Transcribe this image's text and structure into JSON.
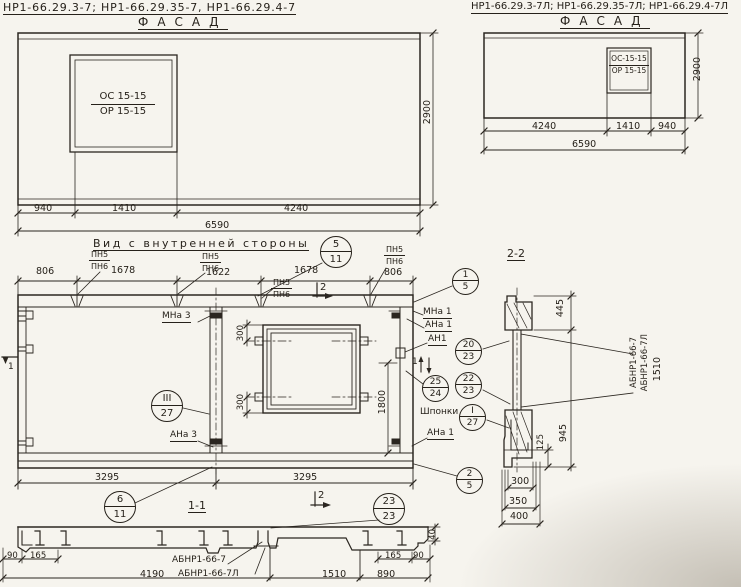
{
  "facade_left": {
    "title": "НР1-66.29.3-7;  НР1-66.29.35-7,  НР1-66.29.4-7",
    "view_label": "ФАСАД",
    "window_mark_top": "ОС 15-15",
    "window_mark_bottom": "ОР 15-15",
    "dim_940": "940",
    "dim_1410": "1410",
    "dim_4240": "4240",
    "dim_total": "6590",
    "dim_height": "2900"
  },
  "facade_right": {
    "title": "НР1-66.29.3-7Л; НР1-66.29.35-7Л; НР1-66.29.4-7Л",
    "view_label": "ФАСАД",
    "window_mark_top": "ОС-15-15",
    "window_mark_bottom": "ОР 15-15",
    "dim_4240": "4240",
    "dim_1410": "1410",
    "dim_940": "940",
    "dim_total": "6590",
    "dim_height": "2900"
  },
  "inner_view": {
    "title": "Вид с внутренней стороны",
    "top_dims": {
      "d1": "806",
      "d2": "1678",
      "d3": "1622",
      "d4": "1678",
      "d5": "806"
    },
    "pn_callout": {
      "top": "ПН5",
      "bottom": "ПН6"
    },
    "labels": {
      "mna3": "МНа 3",
      "ana3": "АНа 3",
      "mna1": "МНа 1",
      "ana1": "АНа 1",
      "an1": "АН1",
      "shponki": "Шпонки",
      "ana1b": "АНа 1"
    },
    "window_dim_top": "300",
    "window_dim_bottom": "300",
    "jamb_dim": "1800",
    "bottom_dim_left": "3295",
    "bottom_dim_right": "3295",
    "section_label": "1-1",
    "cut1": "1",
    "cut2": "2",
    "balloons": {
      "b5_11": {
        "top": "5",
        "bottom": "11"
      },
      "b1_5": {
        "top": "1",
        "bottom": "5"
      },
      "b2_5": {
        "top": "2",
        "bottom": "5"
      },
      "b6_11": {
        "top": "6",
        "bottom": "11"
      },
      "b20_23": {
        "top": "20",
        "bottom": "23"
      },
      "b22_23": {
        "top": "22",
        "bottom": "23"
      },
      "b25_24": {
        "top": "25",
        "bottom": "24"
      },
      "b23_23": {
        "top": "23",
        "bottom": "23"
      },
      "bI_27": {
        "top": "I",
        "bottom": "27"
      },
      "bIII_27": {
        "top": "III",
        "bottom": "27"
      }
    }
  },
  "section_2_2": {
    "title": "2-2",
    "part1": "АБНР1-66-7",
    "part2": "АБНР1-66-7Л",
    "part_dim": "1510",
    "dim_445": "445",
    "dim_945": "945",
    "dim_125": "125",
    "dim_300": "300",
    "dim_350": "350",
    "dim_400": "400"
  },
  "section_1_1": {
    "part1": "АБНР1-66-7",
    "part2": "АБНР1-66-7Л",
    "dim_90l": "90",
    "dim_165l": "165",
    "dim_4190": "4190",
    "dim_1510": "1510",
    "dim_890": "890",
    "dim_165r": "165",
    "dim_90r": "90",
    "dim_40": "40"
  }
}
